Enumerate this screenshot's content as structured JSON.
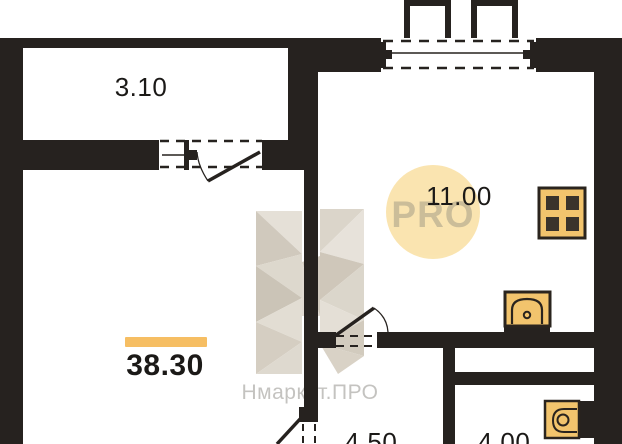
{
  "plan": {
    "type": "apartment-floor-plan",
    "rooms": {
      "balcony": {
        "name": "balcony",
        "area": "3.10"
      },
      "kitchen": {
        "name": "kitchen-living",
        "area": "11.00"
      },
      "main": {
        "name": "main-room-total",
        "area": "38.30"
      },
      "hallway": {
        "name": "hallway",
        "area": "4.50"
      },
      "bathroom": {
        "name": "bathroom",
        "area": "4.00"
      }
    },
    "fixtures": [
      "stove-burners-icon",
      "kitchen-sink-icon",
      "bathtub-icon"
    ],
    "symbols": [
      "window-symbol",
      "door-swing-symbol",
      "dashed-opening-symbol"
    ]
  },
  "watermark": {
    "brand_text": "Нмаркет.ПРО",
    "badge_text": "PRO"
  },
  "colors": {
    "wall": "#26221f",
    "fixture_yellow": "#f2c46d",
    "highlight_bar": "#f6be63",
    "badge_bg": "#fae3ab",
    "badge_text": "#c8b992",
    "watermark_text": "#c4c3c0"
  }
}
